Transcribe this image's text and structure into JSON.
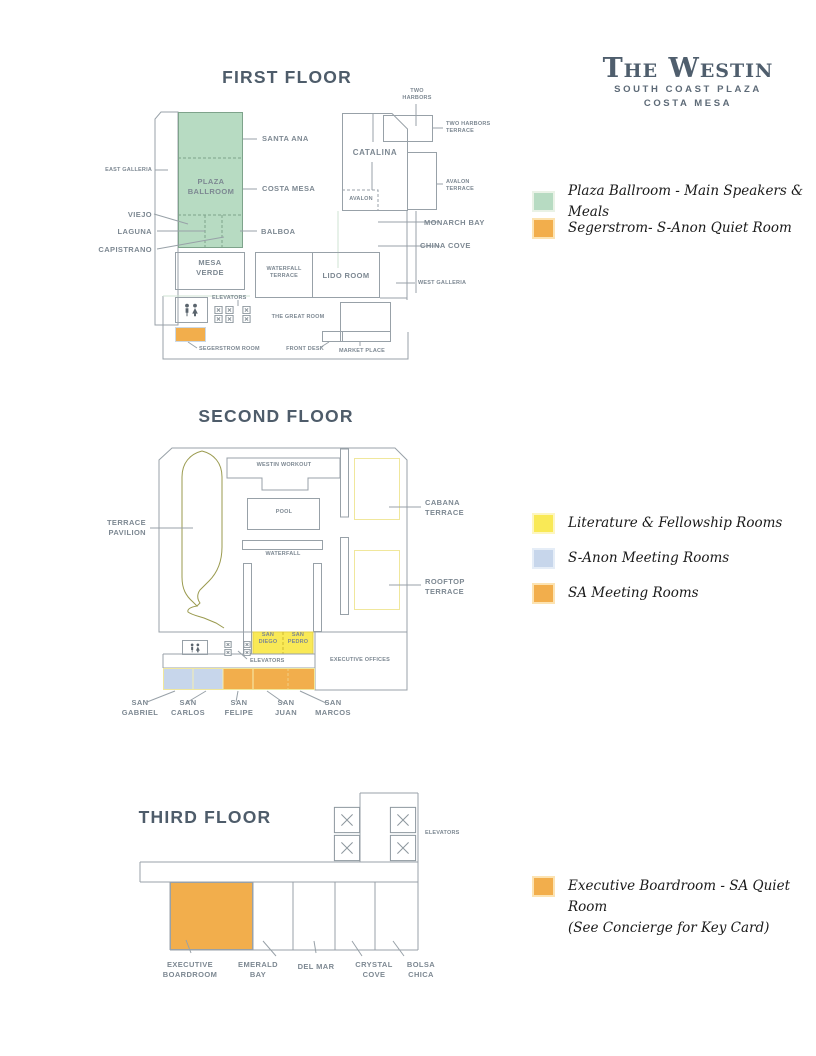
{
  "logo": {
    "brand": "The Westin",
    "sub1": "SOUTH COAST PLAZA",
    "sub2": "COSTA MESA"
  },
  "colors": {
    "green": "#b7dbc2",
    "orange": "#f2ae4c",
    "yellow": "#f9e956",
    "blue": "#c7d6eb",
    "pale_yellow": "#f0e79c",
    "olive": "#9a9a4e",
    "green_halo": "#e9f2e6",
    "orange_halo": "#fce3b2",
    "yellow_halo": "#fdf6c0",
    "blue_halo": "#e5edf7"
  },
  "icons": {
    "restroom": "restroom-icon",
    "elevator": "elevator-x-icon"
  },
  "floor1": {
    "title": "FIRST FLOOR",
    "labels": {
      "two_harbors": "TWO\nHARBORS",
      "two_harbors_terrace": "TWO HARBORS\nTERRACE",
      "east_galleria": "EAST GALLERIA",
      "catalina": "CATALINA",
      "santa_ana": "SANTA ANA",
      "plaza_ballroom": "PLAZA\nBALLROOM",
      "costa_mesa": "COSTA MESA",
      "avalon_terrace": "AVALON\nTERRACE",
      "avalon": "AVALON",
      "viejo": "VIEJO",
      "laguna": "LAGUNA",
      "balboa": "BALBOA",
      "monarch_bay": "MONARCH BAY",
      "capistrano": "CAPISTRANO",
      "china_cove": "CHINA COVE",
      "mesa_verde": "MESA\nVERDE",
      "waterfall_terrace": "WATERFALL\nTERRACE",
      "lido_room": "LIDO ROOM",
      "west_galleria": "WEST GALLERIA",
      "elevators": "ELEVATORS",
      "great_room": "THE GREAT ROOM",
      "segerstrom_room": "SEGERSTROM ROOM",
      "front_desk": "FRONT DESK",
      "market_place": "MARKET PLACE"
    },
    "legend": [
      {
        "label": "Plaza Ballroom - Main Speakers & Meals"
      },
      {
        "label": "Segerstrom- S-Anon Quiet Room"
      }
    ]
  },
  "floor2": {
    "title": "SECOND FLOOR",
    "labels": {
      "westin_workout": "WESTIN WORKOUT",
      "terrace_pavilion": "TERRACE\nPAVILION",
      "cabana_terrace": "CABANA\nTERRACE",
      "pool": "POOL",
      "waterfall": "WATERFALL",
      "rooftop_terrace": "ROOFTOP\nTERRACE",
      "san_diego": "SAN\nDIEGO",
      "san_pedro": "SAN\nPEDRO",
      "executive_offices": "EXECUTIVE OFFICES",
      "elevators": "ELEVATORS",
      "san_gabriel": "SAN\nGABRIEL",
      "san_carlos": "SAN\nCARLOS",
      "san_felipe": "SAN\nFELIPE",
      "san_juan": "SAN\nJUAN",
      "san_marcos": "SAN\nMARCOS"
    },
    "legend": [
      {
        "label": "Literature & Fellowship Rooms"
      },
      {
        "label": "S-Anon Meeting Rooms"
      },
      {
        "label": "SA Meeting Rooms"
      }
    ]
  },
  "floor3": {
    "title": "THIRD FLOOR",
    "labels": {
      "elevators": "ELEVATORS",
      "executive_boardroom": "EXECUTIVE\nBOARDROOM",
      "emerald_bay": "EMERALD\nBAY",
      "del_mar": "DEL MAR",
      "crystal_cove": "CRYSTAL\nCOVE",
      "bolsa_chica": "BOLSA\nCHICA"
    },
    "legend": [
      {
        "label": "Executive Boardroom - SA Quiet Room\n(See Concierge for Key Card)"
      }
    ]
  }
}
